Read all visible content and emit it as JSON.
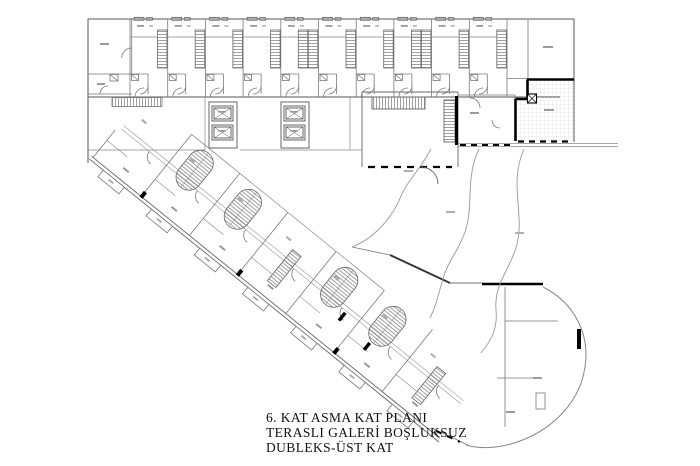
{
  "document": {
    "kind": "architectural floor plan drawing",
    "caption": {
      "line1": "6. KAT ASMA KAT PLANI",
      "line2": "TERASLI GALERİ BOŞLUKSUZ",
      "line3": "DUBLEKS-ÜST KAT"
    }
  },
  "colors": {
    "background": "#ffffff",
    "wall_thin": "#7a7a7a",
    "wall_medium": "#4a4a4a",
    "wall_thick": "#000000",
    "hatch": "#888888",
    "label_mark": "#9a9a9a",
    "caption_text": "#111111"
  },
  "plan": {
    "top_band": {
      "x": 88,
      "y": 19,
      "right": 574,
      "corridor_y": 97,
      "unit_start": 130,
      "unit_width": 37.7,
      "unit_count": 10
    },
    "diagonal_band": {
      "origin_x": 146.6,
      "origin_y": 85,
      "angle_deg": 39,
      "unit_width": 62,
      "unit_count": 7,
      "band_width": 90
    },
    "elevator_pairs": [
      {
        "x": 209,
        "y": 102
      },
      {
        "x": 281,
        "y": 102
      }
    ]
  }
}
